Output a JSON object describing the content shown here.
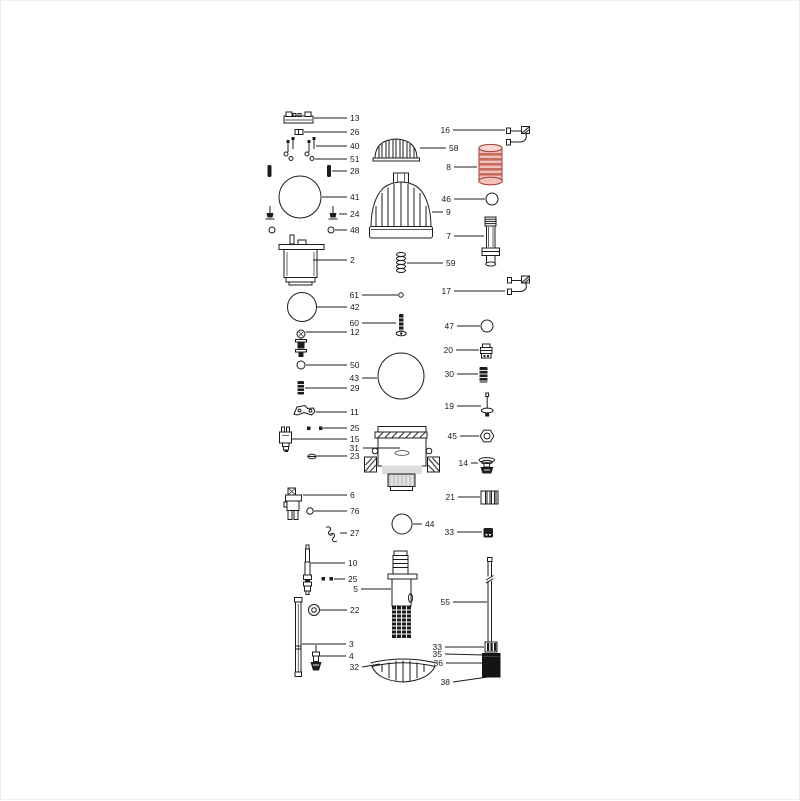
{
  "page": {
    "background": "#ffffff",
    "border_color": "#ededed"
  },
  "diagram": {
    "type": "exploded-parts-diagram",
    "line_color": "#1b1b1b",
    "label_color": "#1b1b1b",
    "highlight": {
      "part_number": "8",
      "fill": "#f0c0ba",
      "stripe": "#c96a5f",
      "stroke": "#a84a42"
    },
    "callouts": [
      {
        "num": "13",
        "part": "clamp-bar",
        "pts": [
          [
            313,
            117
          ],
          [
            346,
            117
          ]
        ],
        "lx": 349,
        "ly": 120,
        "a": "start"
      },
      {
        "num": "26",
        "part": "retainer-clip",
        "pts": [
          [
            303,
            131
          ],
          [
            346,
            131
          ]
        ],
        "lx": 349,
        "ly": 134,
        "a": "start"
      },
      {
        "num": "40",
        "part": "screws",
        "pts": [
          [
            315,
            145
          ],
          [
            346,
            145
          ]
        ],
        "lx": 349,
        "ly": 148,
        "a": "start"
      },
      {
        "num": "51",
        "part": "washers",
        "pts": [
          [
            314,
            158
          ],
          [
            346,
            158
          ]
        ],
        "lx": 349,
        "ly": 161,
        "a": "start"
      },
      {
        "num": "28",
        "part": "pins",
        "pts": [
          [
            331,
            170
          ],
          [
            346,
            170
          ]
        ],
        "lx": 349,
        "ly": 173,
        "a": "start"
      },
      {
        "num": "41",
        "part": "o-ring-large",
        "pts": [
          [
            321,
            196
          ],
          [
            346,
            196
          ]
        ],
        "lx": 349,
        "ly": 199,
        "a": "start"
      },
      {
        "num": "24",
        "part": "bolts",
        "pts": [
          [
            338,
            213
          ],
          [
            346,
            213
          ]
        ],
        "lx": 349,
        "ly": 216,
        "a": "start"
      },
      {
        "num": "48",
        "part": "rings-small",
        "pts": [
          [
            334,
            229
          ],
          [
            346,
            229
          ]
        ],
        "lx": 349,
        "ly": 232,
        "a": "start"
      },
      {
        "num": "2",
        "part": "motor-housing",
        "pts": [
          [
            312,
            259
          ],
          [
            346,
            259
          ]
        ],
        "lx": 349,
        "ly": 262,
        "a": "start"
      },
      {
        "num": "61",
        "part": "pin-small",
        "pts": [
          [
            361,
            294
          ],
          [
            397,
            294
          ]
        ],
        "lx": 358,
        "ly": 297,
        "a": "end"
      },
      {
        "num": "42",
        "part": "o-ring-medium",
        "pts": [
          [
            316,
            306
          ],
          [
            346,
            306
          ]
        ],
        "lx": 349,
        "ly": 309,
        "a": "start"
      },
      {
        "num": "60",
        "part": "screw-threaded",
        "pts": [
          [
            361,
            322
          ],
          [
            395,
            322
          ]
        ],
        "lx": 358,
        "ly": 325,
        "a": "end"
      },
      {
        "num": "12",
        "part": "bolt-assembly",
        "pts": [
          [
            305,
            331
          ],
          [
            346,
            331
          ]
        ],
        "lx": 349,
        "ly": 334,
        "a": "start"
      },
      {
        "num": "50",
        "part": "o-ring-small",
        "pts": [
          [
            305,
            364
          ],
          [
            346,
            364
          ]
        ],
        "lx": 349,
        "ly": 367,
        "a": "start"
      },
      {
        "num": "43",
        "part": "o-ring-large",
        "pts": [
          [
            361,
            377
          ],
          [
            376,
            377
          ]
        ],
        "lx": 358,
        "ly": 380,
        "a": "end"
      },
      {
        "num": "29",
        "part": "pin-ribbed",
        "pts": [
          [
            304,
            387
          ],
          [
            346,
            387
          ]
        ],
        "lx": 349,
        "ly": 390,
        "a": "start"
      },
      {
        "num": "11",
        "part": "lever-bracket",
        "pts": [
          [
            315,
            411
          ],
          [
            346,
            411
          ]
        ],
        "lx": 349,
        "ly": 414,
        "a": "start"
      },
      {
        "num": "25",
        "part": "square-nuts",
        "pts": [
          [
            322,
            427
          ],
          [
            346,
            427
          ]
        ],
        "lx": 349,
        "ly": 430,
        "a": "start"
      },
      {
        "num": "15",
        "part": "valve-body",
        "pts": [
          [
            291,
            438
          ],
          [
            346,
            438
          ]
        ],
        "lx": 349,
        "ly": 441,
        "a": "start"
      },
      {
        "num": "31",
        "part": "pump-housing",
        "pts": [
          [
            362,
            447
          ],
          [
            399,
            447
          ]
        ],
        "lx": 358,
        "ly": 450,
        "a": "end"
      },
      {
        "num": "23",
        "part": "clip-small",
        "pts": [
          [
            316,
            455
          ],
          [
            346,
            455
          ]
        ],
        "lx": 349,
        "ly": 458,
        "a": "start"
      },
      {
        "num": "6",
        "part": "valve-assembly",
        "pts": [
          [
            302,
            494
          ],
          [
            346,
            494
          ]
        ],
        "lx": 349,
        "ly": 497,
        "a": "start"
      },
      {
        "num": "76",
        "part": "o-ring-small",
        "pts": [
          [
            313,
            510
          ],
          [
            346,
            510
          ]
        ],
        "lx": 349,
        "ly": 513,
        "a": "start"
      },
      {
        "num": "27",
        "part": "spring-clips",
        "pts": [
          [
            339,
            532
          ],
          [
            346,
            532
          ]
        ],
        "lx": 349,
        "ly": 535,
        "a": "start"
      },
      {
        "num": "44",
        "part": "o-ring-medium",
        "pts": [
          [
            412,
            523
          ],
          [
            421,
            523
          ]
        ],
        "lx": 424,
        "ly": 526,
        "a": "start"
      },
      {
        "num": "10",
        "part": "shaft-rod",
        "pts": [
          [
            310,
            562
          ],
          [
            344,
            562
          ]
        ],
        "lx": 347,
        "ly": 565,
        "a": "start"
      },
      {
        "num": "25",
        "part": "square-nuts",
        "pts": [
          [
            333,
            578
          ],
          [
            344,
            578
          ]
        ],
        "lx": 347,
        "ly": 581,
        "a": "start"
      },
      {
        "num": "5",
        "part": "impeller-assembly",
        "pts": [
          [
            360,
            588
          ],
          [
            390,
            588
          ]
        ],
        "lx": 357,
        "ly": 591,
        "a": "end"
      },
      {
        "num": "22",
        "part": "nut",
        "pts": [
          [
            319,
            609
          ],
          [
            346,
            609
          ]
        ],
        "lx": 349,
        "ly": 612,
        "a": "start"
      },
      {
        "num": "3",
        "part": "tube-long",
        "pts": [
          [
            301,
            643
          ],
          [
            345,
            643
          ]
        ],
        "lx": 348,
        "ly": 646,
        "a": "start"
      },
      {
        "num": "4",
        "part": "valve-small",
        "pts": [
          [
            319,
            655
          ],
          [
            345,
            655
          ]
        ],
        "lx": 348,
        "ly": 658,
        "a": "start"
      },
      {
        "num": "32",
        "part": "strainer-dome",
        "pts": [
          [
            361,
            666
          ],
          [
            379,
            663
          ]
        ],
        "lx": 358,
        "ly": 669,
        "a": "end"
      },
      {
        "num": "16",
        "part": "hose-hook",
        "pts": [
          [
            452,
            129
          ],
          [
            504,
            129
          ]
        ],
        "lx": 449,
        "ly": 132,
        "a": "end"
      },
      {
        "num": "58",
        "part": "cap-striped",
        "pts": [
          [
            419,
            147
          ],
          [
            445,
            147
          ]
        ],
        "lx": 448,
        "ly": 150,
        "a": "start"
      },
      {
        "num": "8",
        "part": "coupling-highlighted",
        "pts": [
          [
            453,
            166
          ],
          [
            476,
            166
          ]
        ],
        "lx": 450,
        "ly": 169,
        "a": "end"
      },
      {
        "num": "46",
        "part": "o-ring",
        "pts": [
          [
            453,
            198
          ],
          [
            484,
            198
          ]
        ],
        "lx": 450,
        "ly": 201,
        "a": "end"
      },
      {
        "num": "9",
        "part": "strainer-cage",
        "pts": [
          [
            431,
            211
          ],
          [
            442,
            211
          ]
        ],
        "lx": 445,
        "ly": 214,
        "a": "start"
      },
      {
        "num": "7",
        "part": "outlet-fitting",
        "pts": [
          [
            453,
            235
          ],
          [
            483,
            235
          ]
        ],
        "lx": 450,
        "ly": 238,
        "a": "end"
      },
      {
        "num": "59",
        "part": "spring",
        "pts": [
          [
            406,
            262
          ],
          [
            442,
            262
          ]
        ],
        "lx": 445,
        "ly": 265,
        "a": "start"
      },
      {
        "num": "17",
        "part": "hose-hook",
        "pts": [
          [
            453,
            290
          ],
          [
            504,
            290
          ]
        ],
        "lx": 450,
        "ly": 293,
        "a": "end"
      },
      {
        "num": "47",
        "part": "o-ring",
        "pts": [
          [
            456,
            325
          ],
          [
            479,
            325
          ]
        ],
        "lx": 453,
        "ly": 328,
        "a": "end"
      },
      {
        "num": "20",
        "part": "cap-fitting",
        "pts": [
          [
            455,
            349
          ],
          [
            478,
            349
          ]
        ],
        "lx": 452,
        "ly": 352,
        "a": "end"
      },
      {
        "num": "30",
        "part": "pin-ribbed",
        "pts": [
          [
            456,
            373
          ],
          [
            477,
            373
          ]
        ],
        "lx": 453,
        "ly": 376,
        "a": "end"
      },
      {
        "num": "19",
        "part": "screw-long",
        "pts": [
          [
            456,
            405
          ],
          [
            480,
            405
          ]
        ],
        "lx": 453,
        "ly": 408,
        "a": "end"
      },
      {
        "num": "45",
        "part": "hex-nut",
        "pts": [
          [
            459,
            435
          ],
          [
            478,
            435
          ]
        ],
        "lx": 456,
        "ly": 438,
        "a": "end"
      },
      {
        "num": "14",
        "part": "valve-poppet",
        "pts": [
          [
            470,
            462
          ],
          [
            477,
            462
          ]
        ],
        "lx": 467,
        "ly": 465,
        "a": "end"
      },
      {
        "num": "21",
        "part": "threaded-insert",
        "pts": [
          [
            457,
            496
          ],
          [
            479,
            496
          ]
        ],
        "lx": 454,
        "ly": 499,
        "a": "end"
      },
      {
        "num": "33",
        "part": "cap-small",
        "pts": [
          [
            456,
            531
          ],
          [
            481,
            531
          ]
        ],
        "lx": 453,
        "ly": 534,
        "a": "end"
      },
      {
        "num": "55",
        "part": "float-rod",
        "pts": [
          [
            452,
            601
          ],
          [
            486,
            601
          ]
        ],
        "lx": 449,
        "ly": 604,
        "a": "end"
      },
      {
        "num": "33",
        "part": "collar-ribbed",
        "pts": [
          [
            444,
            646
          ],
          [
            483,
            646
          ]
        ],
        "lx": 441,
        "ly": 649,
        "a": "end"
      },
      {
        "num": "35",
        "part": "float-block-top",
        "pts": [
          [
            444,
            653
          ],
          [
            483,
            654
          ]
        ],
        "lx": 441,
        "ly": 656,
        "a": "end"
      },
      {
        "num": "36",
        "part": "float-block",
        "pts": [
          [
            445,
            662
          ],
          [
            481,
            662
          ]
        ],
        "lx": 442,
        "ly": 665,
        "a": "end"
      },
      {
        "num": "38",
        "part": "float-block-bottom",
        "pts": [
          [
            452,
            681
          ],
          [
            487,
            676
          ]
        ],
        "lx": 449,
        "ly": 684,
        "a": "end"
      }
    ]
  }
}
